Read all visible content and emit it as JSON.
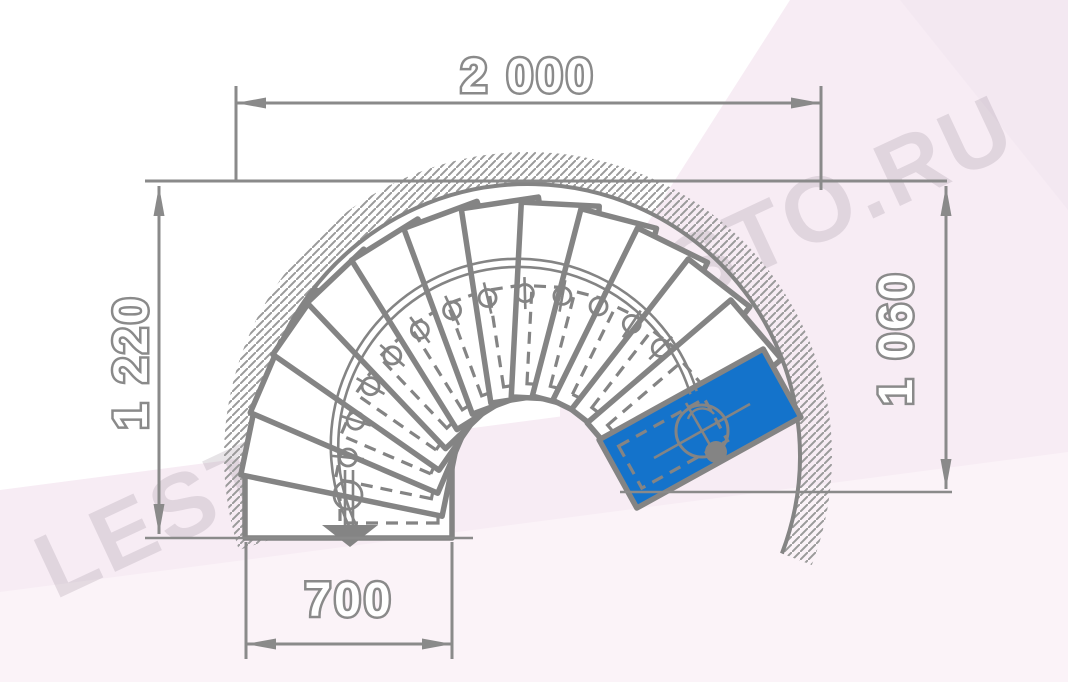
{
  "drawing": {
    "type": "spiral-staircase-plan-view",
    "units": "mm"
  },
  "dimensions": {
    "top": {
      "label": "2 000",
      "meaning": "overall outside diameter"
    },
    "left": {
      "label": "1 220",
      "meaning": "height from top wall line to bottom step edge"
    },
    "right": {
      "label": "1 060",
      "meaning": "height from top wall line to lower landing line"
    },
    "bottom": {
      "label": "700",
      "meaning": "width of entry step"
    }
  },
  "stair": {
    "total_steps": 14,
    "white_steps": 13,
    "highlighted_step": "top step / landing (blue)",
    "entry_marker": "down arrow on walk line at bottom step",
    "walk_line_markers": 13,
    "center_pole": "filled circle with centerline circle symbol on blue step"
  },
  "watermark": {
    "text": "LESTNICI-PROSTO.RU"
  },
  "colors": {
    "line_gray": "#848484",
    "dim_gray": "#8a8a8a",
    "step_fill": "#ffffff",
    "accent_blue": "#1473cb",
    "bg_pink": "#f7ecf4",
    "bg_pink_light": "#fbf3f8",
    "bg_pink_deep": "#f3e8f1",
    "hatch": "#9a9a9a"
  }
}
